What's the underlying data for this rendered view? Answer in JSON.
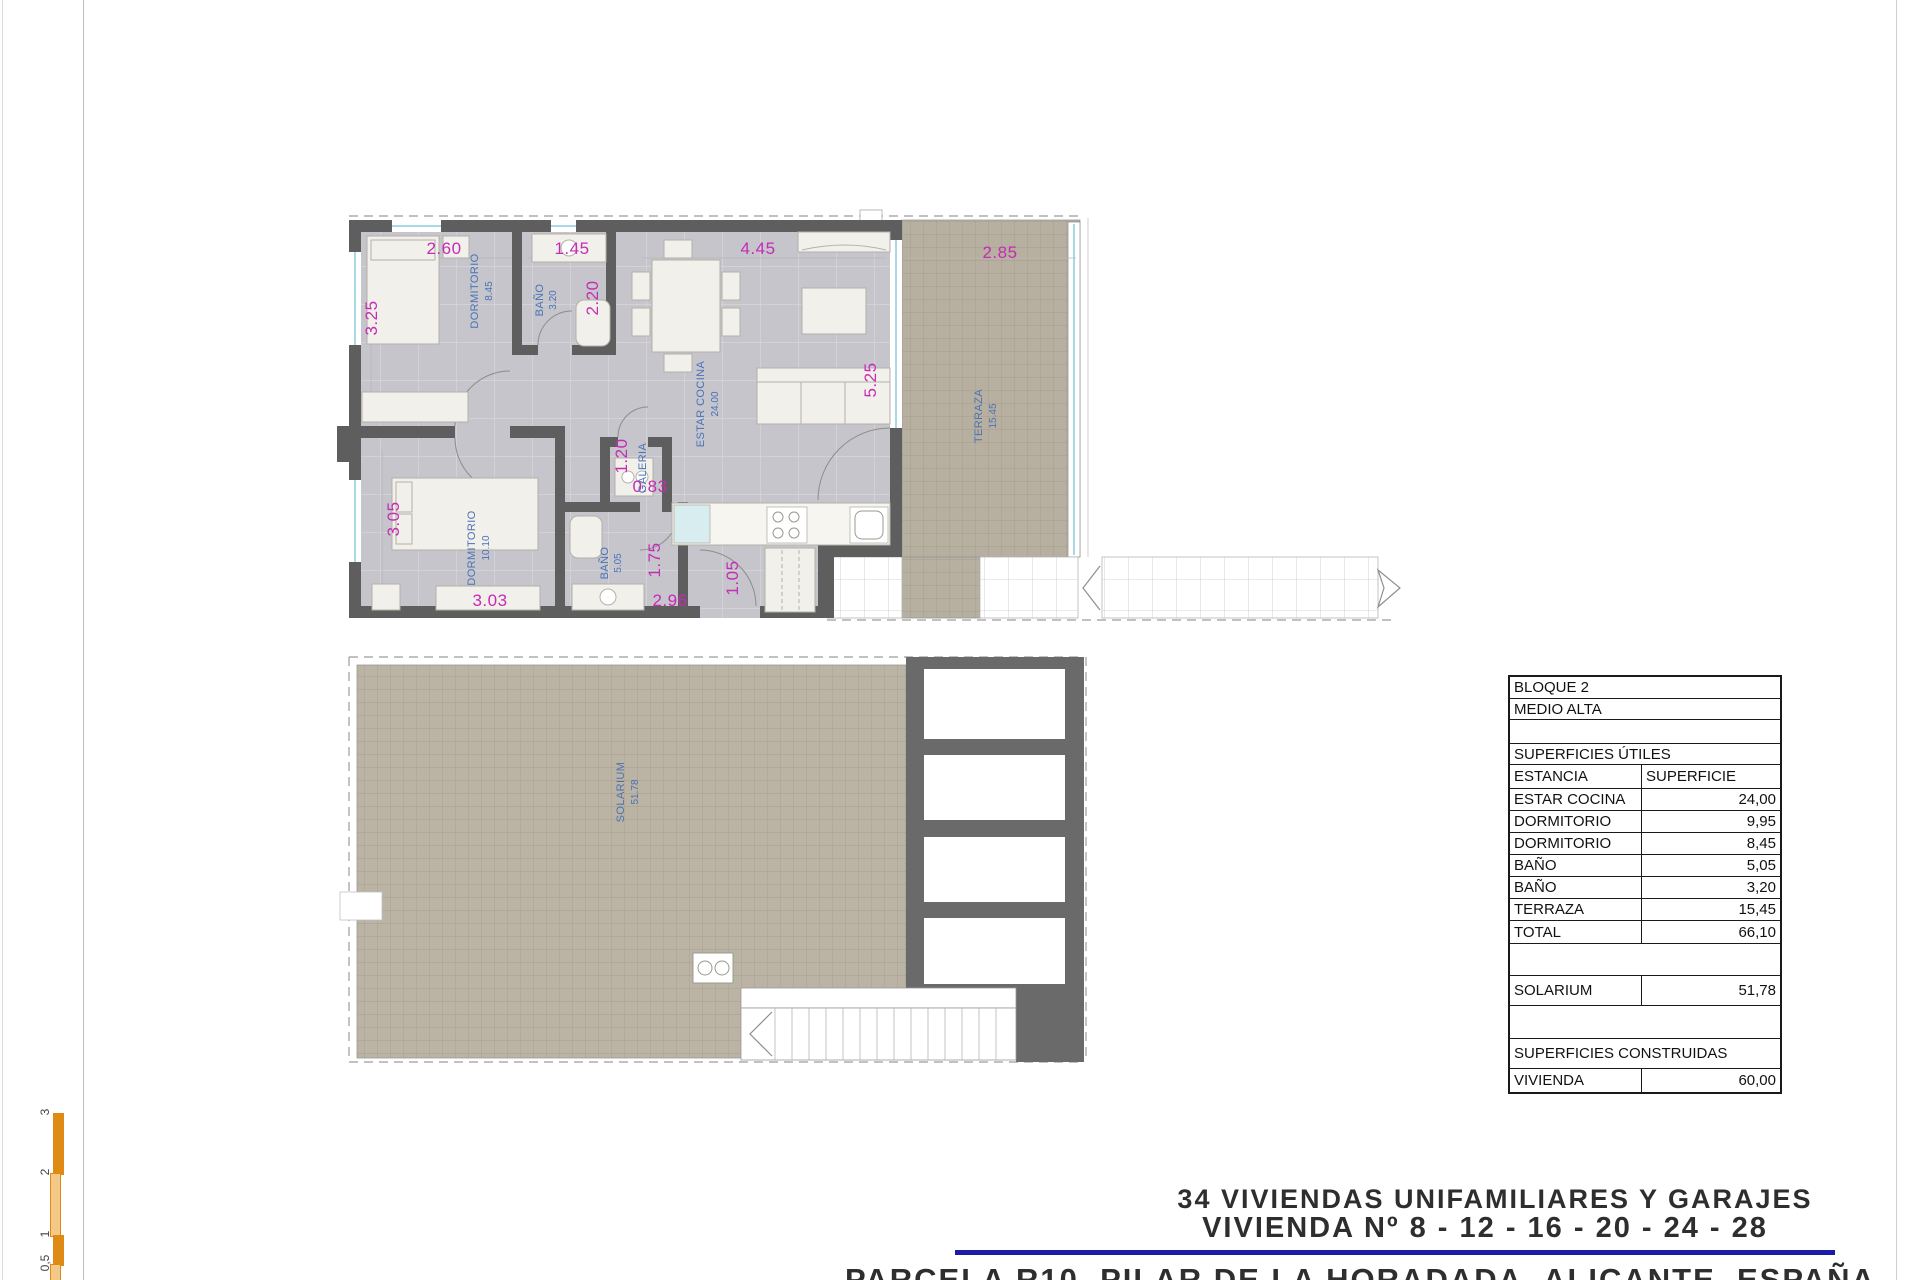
{
  "upper_plan": {
    "rooms": [
      {
        "name": "DORMITORIO",
        "area": "8.45"
      },
      {
        "name": "BAÑO",
        "area": "3.20"
      },
      {
        "name": "ESTAR COCINA",
        "area": "24.00"
      },
      {
        "name": "GALERIA",
        "area": ""
      },
      {
        "name": "DORMITORIO",
        "area": "10.10"
      },
      {
        "name": "BAÑO",
        "area": "5.05"
      },
      {
        "name": "TERRAZA",
        "area": "15.45"
      }
    ],
    "dims_top": [
      "2.60",
      "1.45",
      "4.45",
      "2.85"
    ],
    "dims_left": [
      "3.25",
      "3.05"
    ],
    "dims_other": [
      "2.20",
      "5.25",
      "1.20",
      "0.83",
      "1.75",
      "1.05",
      "3.03",
      "2.96"
    ]
  },
  "lower_plan": {
    "room": {
      "name": "SOLARIUM",
      "area": "51.78"
    }
  },
  "areas_table": {
    "block": "BLOQUE 2",
    "level": "MEDIO ALTA",
    "useful_title": "SUPERFICIES ÚTILES",
    "col_room": "ESTANCIA",
    "col_area": "SUPERFICIE",
    "rows": [
      {
        "room": "ESTAR COCINA",
        "area": "24,00"
      },
      {
        "room": "DORMITORIO",
        "area": "9,95"
      },
      {
        "room": "DORMITORIO",
        "area": "8,45"
      },
      {
        "room": "BAÑO",
        "area": "5,05"
      },
      {
        "room": "BAÑO",
        "area": "3,20"
      },
      {
        "room": "TERRAZA",
        "area": "15,45"
      },
      {
        "room": "TOTAL",
        "area": "66,10"
      }
    ],
    "solarium": {
      "room": "SOLARIUM",
      "area": "51,78"
    },
    "built_title": "SUPERFICIES CONSTRUIDAS",
    "built_row": {
      "room": "VIVIENDA",
      "area": "60,00"
    }
  },
  "title_block": {
    "line1": "34 VIVIENDAS UNIFAMILIARES Y GARAJES",
    "line2": "VIVIENDA Nº 8 - 12 - 16 - 20 - 24 - 28",
    "line3": "PARCELA R10, PILAR DE LA HORADADA, ALICANTE, ESPAÑA",
    "accent_color": "#1b1ba8"
  },
  "scale_bar": {
    "labels": [
      "3",
      "2",
      "1",
      "0,5"
    ],
    "color": "#df8a15"
  }
}
